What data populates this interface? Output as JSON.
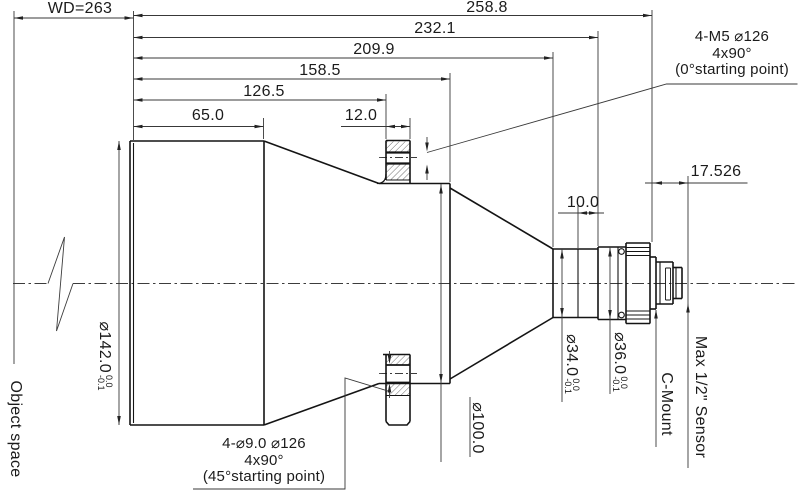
{
  "drawing": {
    "dimensions": {
      "wd": "WD=263",
      "d258": "258.8",
      "d232": "232.1",
      "d209": "209.9",
      "d158": "158.5",
      "d126": "126.5",
      "d65": "65.0",
      "d12": "12.0",
      "d10": "10.0",
      "d17": "17.526"
    },
    "diameters": {
      "d142": {
        "label": "⌀142.0",
        "tol_plus": "0.0",
        "tol_minus": "-0.1"
      },
      "d100": {
        "label": "⌀100.0"
      },
      "d34": {
        "label": "⌀34.0",
        "tol_plus": "0.0",
        "tol_minus": "-0.1"
      },
      "d36": {
        "label": "⌀36.0",
        "tol_plus": "0.0",
        "tol_minus": "-0.1"
      }
    },
    "notes": {
      "top": {
        "line1": "4-M5 ⌀126",
        "line2": "4x90°",
        "line3": "(0°starting point)"
      },
      "bottom": {
        "line1": "4-⌀9.0  ⌀126",
        "line2": "4x90°",
        "line3": "(45°starting point)"
      }
    },
    "labels": {
      "object_space": "Object space",
      "c_mount": "C-Mount",
      "max_sensor": "Max 1/2\" Sensor"
    }
  }
}
